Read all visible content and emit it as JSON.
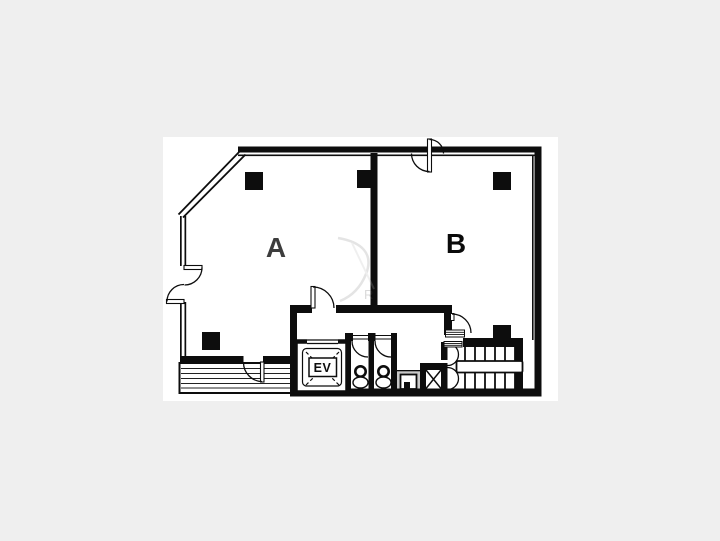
{
  "page": {
    "background_color": "#efefef",
    "plan_background": "#ffffff"
  },
  "floor_plan": {
    "rooms": [
      {
        "label": "A"
      },
      {
        "label": "B"
      }
    ],
    "elevator": {
      "label": "EV"
    },
    "watermark": {
      "letter": "R"
    },
    "colors": {
      "wall": "#0d0d0d",
      "room_a_label": "#3d3d3d",
      "room_b_label": "#0a0a0a",
      "sink_area": "#c9c9c9",
      "balcony_line": "#222222"
    }
  }
}
